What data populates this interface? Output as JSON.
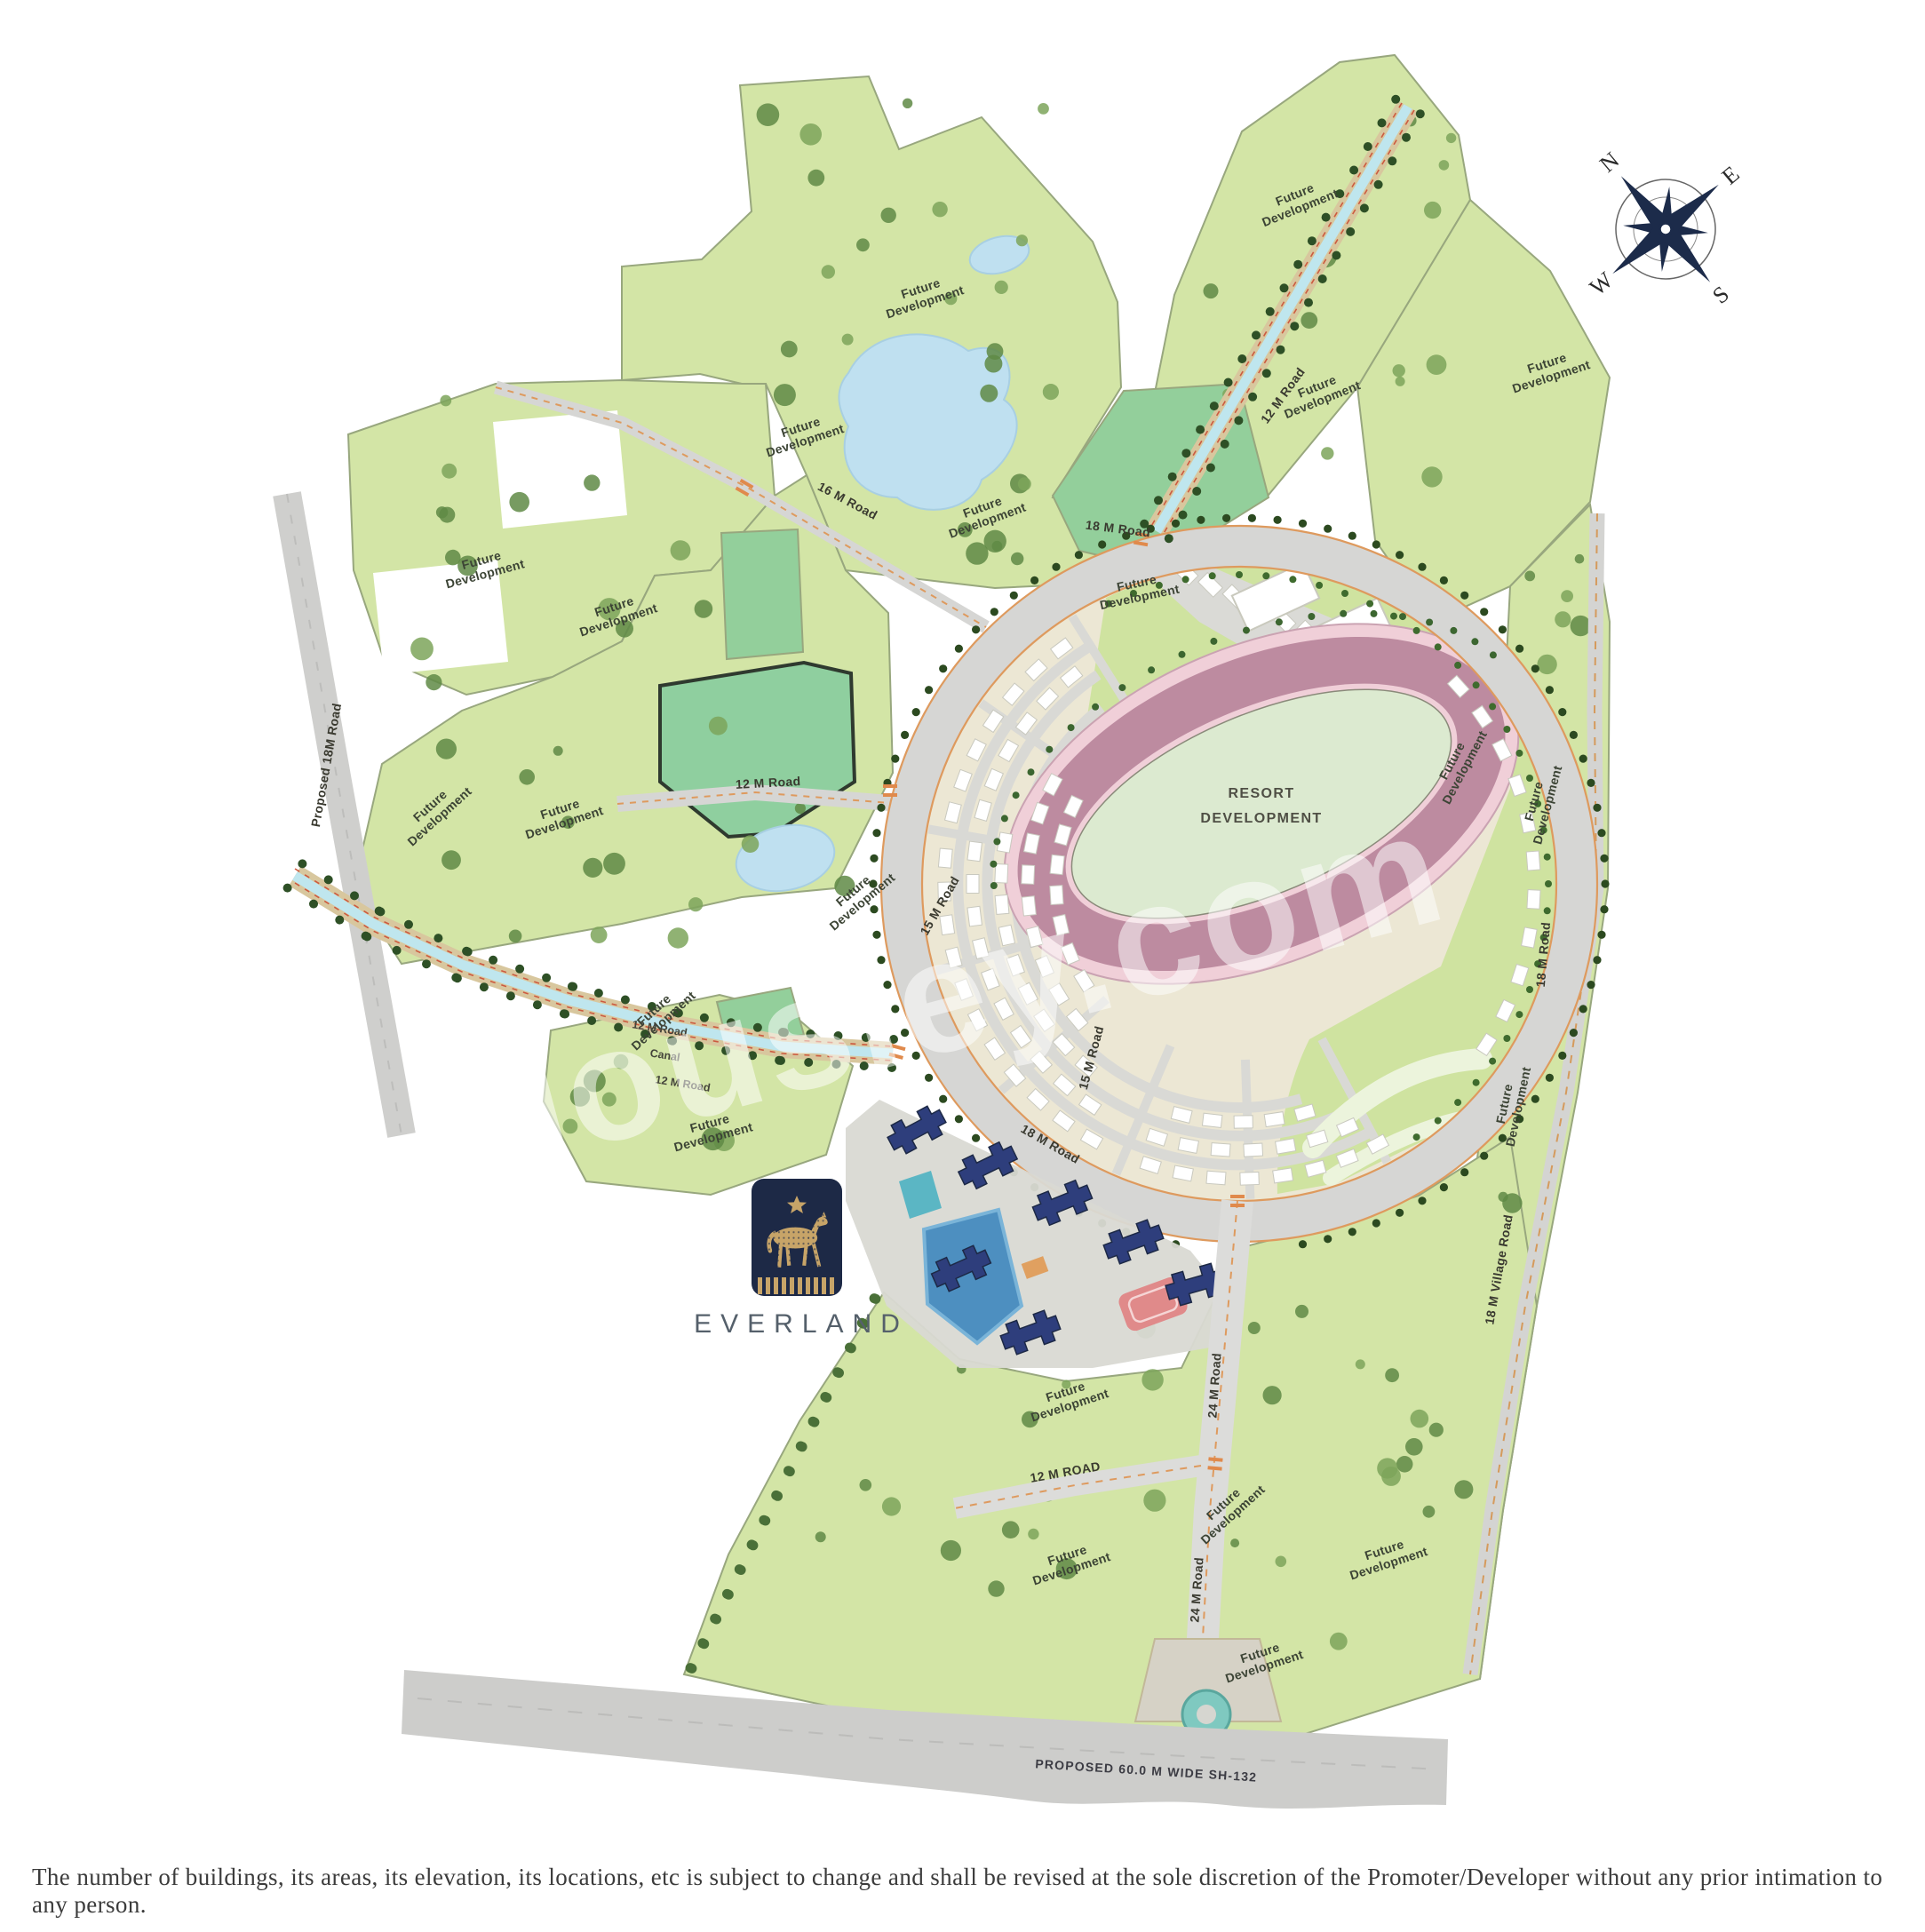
{
  "page": {
    "disclaimer": "The number of buildings, its areas, its elevation, its locations, etc is subject to change and shall be revised at the sole discretion of the Promoter/Developer without any prior intimation to any person."
  },
  "watermark": {
    "text": "Housiey.com"
  },
  "brand": {
    "name": "EVERLAND"
  },
  "compass": {
    "n": "N",
    "e": "E",
    "s": "S",
    "w": "W"
  },
  "labels": {
    "future_line1": "Future",
    "future_line2": "Development",
    "resort_line1": "RESORT",
    "resort_line2": "DEVELOPMENT"
  },
  "roads": {
    "r18": "18 M Road",
    "r12": "12 M Road",
    "r15": "15 M Road",
    "r16": "16 M Road",
    "r24": "24 M Road",
    "r12_stub": "12 M ROAD",
    "canal": "Canal",
    "left_road": "Proposed 18M Road",
    "village_road": "18 M Village Road",
    "highway": "PROPOSED 60.0 M WIDE SH-132"
  },
  "colors": {
    "parcel": "#d3e5a6",
    "parcel_dark": "#93cf9b",
    "pond": "#bfe0f0",
    "road_gray": "#d6d6d4",
    "track_mauve": "#bd8ba0",
    "logo_navy": "#1d2946",
    "logo_gold": "#c7a468"
  }
}
